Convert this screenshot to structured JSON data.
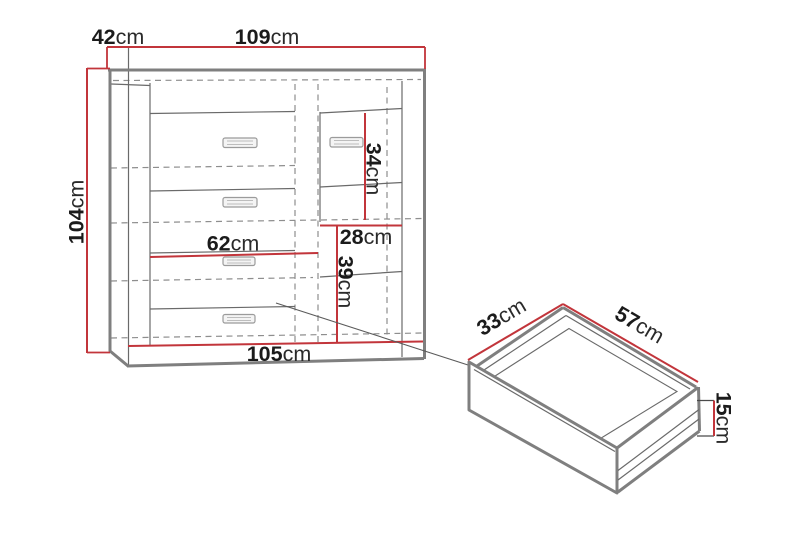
{
  "colors": {
    "dimension": "#c2353b",
    "outline": "#7f7f7f",
    "line": "#6a6a6a",
    "dashed": "#8e8e8e",
    "pointer": "#5a5a5a",
    "text": "#1b1b1b",
    "handle": "#9b9b9b"
  },
  "cabinet": {
    "depth": {
      "value": "42",
      "unit": "cm"
    },
    "width": {
      "value": "109",
      "unit": "cm"
    },
    "height": {
      "value": "104",
      "unit": "cm"
    },
    "door_section_height": {
      "value": "34",
      "unit": "cm"
    },
    "side_section_width": {
      "value": "28",
      "unit": "cm"
    },
    "side_lower_height": {
      "value": "39",
      "unit": "cm"
    },
    "drawer_section_width": {
      "value": "62",
      "unit": "cm"
    },
    "base_width": {
      "value": "105",
      "unit": "cm"
    }
  },
  "drawer_detail": {
    "depth": {
      "value": "33",
      "unit": "cm"
    },
    "width": {
      "value": "57",
      "unit": "cm"
    },
    "height": {
      "value": "15",
      "unit": "cm"
    }
  }
}
